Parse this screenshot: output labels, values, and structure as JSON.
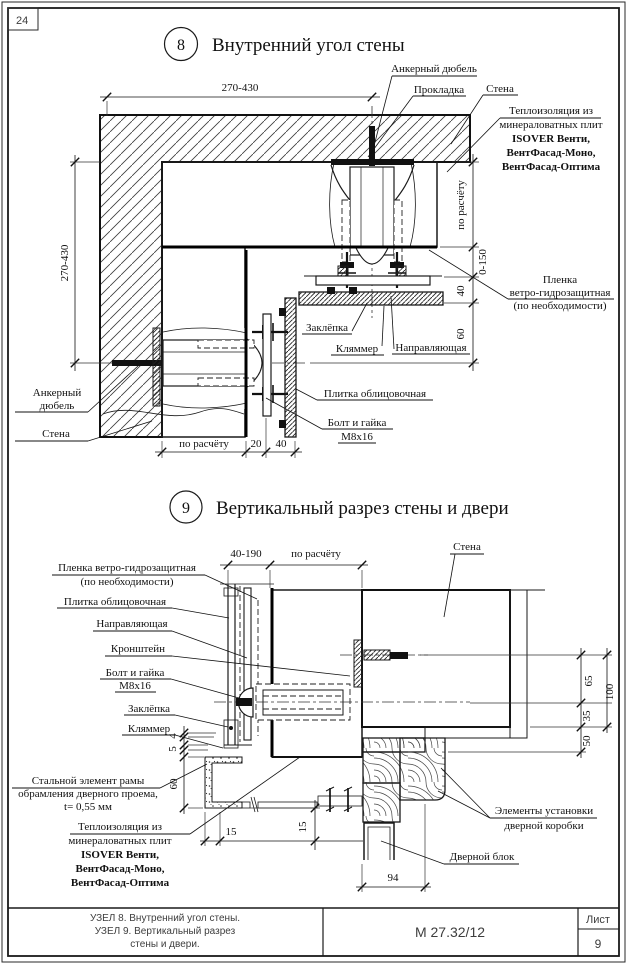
{
  "page": {
    "corner_number": "24"
  },
  "title_block": {
    "description_lines": [
      "УЗЕЛ 8. Внутренний угол стены.",
      "УЗЕЛ 9. Вертикальный разрез",
      "стены и двери."
    ],
    "doc_number": "М 27.32/12",
    "sheet_label": "Лист",
    "sheet_number": "9"
  },
  "detail8": {
    "number": "8",
    "title": "Внутренний угол стены",
    "labels": [
      {
        "name": "label-anchor-dowel-top",
        "lines": [
          "Анкерный дюбель"
        ],
        "x": 434,
        "y": 72,
        "lh": 13,
        "underlines": [
          [
            392,
            477,
            76
          ]
        ],
        "leaders": [
          [
            [
              392,
              76
            ],
            [
              374,
              146
            ]
          ]
        ]
      },
      {
        "name": "label-gasket",
        "lines": [
          "Прокладка"
        ],
        "x": 439,
        "y": 93,
        "lh": 13,
        "underlines": [
          [
            413,
            466,
            96
          ]
        ],
        "leaders": [
          [
            [
              413,
              96
            ],
            [
              368,
              157
            ]
          ]
        ]
      },
      {
        "name": "label-wall-top",
        "lines": [
          "Стена"
        ],
        "x": 500,
        "y": 92,
        "lh": 13,
        "underlines": [
          [
            483,
            518,
            95
          ]
        ],
        "leaders": [
          [
            [
              483,
              95
            ],
            [
              451,
              144
            ]
          ]
        ]
      },
      {
        "name": "label-insulation-8",
        "lines": [
          "Теплоизоляция из",
          "минераловатных плит",
          "ISOVER Венти,",
          "ВентФасад-Моно,",
          "ВентФасад-Оптима"
        ],
        "x": 551,
        "y": 114,
        "lh": 14,
        "bold_from": 2,
        "underlines": [
          [
            500,
            601,
            118
          ]
        ],
        "leaders": [
          [
            [
              500,
              118
            ],
            [
              447,
              172
            ]
          ]
        ]
      },
      {
        "name": "label-membrane-8",
        "lines": [
          "Пленка",
          "ветро-гидрозащитная",
          "(по необходимости)"
        ],
        "x": 560,
        "y": 283,
        "lh": 13,
        "underlines": [
          [
            508,
            614,
            299
          ]
        ],
        "leaders": [
          [
            [
              508,
              299
            ],
            [
              429,
              250
            ]
          ]
        ]
      },
      {
        "name": "label-rivet-8",
        "lines": [
          "Заклёпка"
        ],
        "x": 327,
        "y": 331,
        "lh": 13,
        "underlines": [
          [
            302,
            352,
            334
          ]
        ],
        "leaders": [
          [
            [
              352,
              331
            ],
            [
              367,
              303
            ]
          ]
        ]
      },
      {
        "name": "label-clamp-8",
        "lines": [
          "Кляммер"
        ],
        "x": 357,
        "y": 352,
        "lh": 13,
        "underlines": [
          [
            331,
            384,
            355
          ]
        ],
        "leaders": [
          [
            [
              382,
              346
            ],
            [
              384,
              306
            ]
          ]
        ]
      },
      {
        "name": "label-rail-8",
        "lines": [
          "Направляющая"
        ],
        "x": 431,
        "y": 351,
        "lh": 13,
        "underlines": [
          [
            392,
            470,
            354
          ]
        ],
        "leaders": [
          [
            [
              394,
              349
            ],
            [
              391,
              296
            ]
          ]
        ]
      },
      {
        "name": "label-tile-8",
        "lines": [
          "Плитка облицовочная"
        ],
        "x": 375,
        "y": 397,
        "lh": 13,
        "underlines": [
          [
            317,
            433,
            400
          ]
        ],
        "leaders": [
          [
            [
              317,
              400
            ],
            [
              296,
              389
            ]
          ]
        ]
      },
      {
        "name": "label-bolt-8",
        "lines": [
          "Болт и гайка",
          "М8х16"
        ],
        "x": 357,
        "y": 426,
        "lh": 14,
        "underlines": [
          [
            322,
            393,
            429
          ],
          [
            338,
            376,
            443
          ]
        ],
        "leaders": [
          [
            [
              322,
              429
            ],
            [
              266,
              398
            ]
          ]
        ]
      },
      {
        "name": "label-anchor-dowel-left",
        "lines": [
          "Анкерный",
          "дюбель"
        ],
        "x": 57,
        "y": 396,
        "lh": 13,
        "underlines": [
          [
            15,
            88,
            412
          ]
        ],
        "leaders": [
          [
            [
              88,
              412
            ],
            [
              138,
              366
            ]
          ]
        ]
      },
      {
        "name": "label-wall-left",
        "lines": [
          "Стена"
        ],
        "x": 56,
        "y": 437,
        "lh": 13,
        "underlines": [
          [
            15,
            88,
            441
          ]
        ],
        "leaders": [
          [
            [
              88,
              441
            ],
            [
              152,
              421
            ]
          ]
        ]
      }
    ],
    "dims": [
      {
        "name": "dim-270-430-top",
        "text": "270-430",
        "tx": 240,
        "ty": 91,
        "rot": 0,
        "line": [
          100,
          97,
          380,
          97
        ],
        "ticks": [
          [
            107,
            97
          ],
          [
            372,
            97
          ]
        ]
      },
      {
        "name": "dim-270-430-left",
        "text": "270-430",
        "tx": 68,
        "ty": 263,
        "rot": 1,
        "line": [
          75,
          155,
          75,
          371
        ],
        "ticks": [
          [
            75,
            162
          ],
          [
            75,
            363
          ]
        ]
      },
      {
        "name": "dim-po-raschetu-right",
        "text": "по расчёту",
        "tx": 464,
        "ty": 205,
        "rot": 1,
        "line": [
          473,
          154,
          473,
          371
        ],
        "ticks": [
          [
            473,
            162
          ],
          [
            473,
            247
          ]
        ]
      },
      {
        "name": "dim-0-150",
        "text": "0-150",
        "tx": 486,
        "ty": 262,
        "rot": 1,
        "ticks": [
          [
            473,
            277
          ]
        ]
      },
      {
        "name": "dim-40-right",
        "text": "40",
        "tx": 464,
        "ty": 291,
        "rot": 1,
        "ticks": [
          [
            473,
            303
          ]
        ]
      },
      {
        "name": "dim-60-right",
        "text": "60",
        "tx": 464,
        "ty": 334,
        "rot": 1,
        "ticks": [
          [
            473,
            363
          ]
        ]
      },
      {
        "name": "dim-po-raschetu-bottom",
        "text": "по расчёту",
        "tx": 204,
        "ty": 447,
        "rot": 0,
        "line": [
          155,
          452,
          302,
          452
        ],
        "ticks": [
          [
            162,
            452
          ],
          [
            246,
            452
          ]
        ]
      },
      {
        "name": "dim-20-bottom",
        "text": "20",
        "tx": 256,
        "ty": 447,
        "rot": 0,
        "ticks": [
          [
            266,
            452
          ]
        ]
      },
      {
        "name": "dim-40-bottom",
        "text": "40",
        "tx": 281,
        "ty": 447,
        "rot": 0,
        "ticks": [
          [
            295,
            452
          ]
        ]
      }
    ]
  },
  "detail9": {
    "number": "9",
    "title": "Вертикальный разрез стены и двери",
    "labels": [
      {
        "name": "label-membrane-9",
        "lines": [
          "Пленка ветро-гидрозащитная",
          "(по необходимости)"
        ],
        "x": 127,
        "y": 571,
        "lh": 14,
        "underlines": [
          [
            52,
            205,
            575
          ]
        ],
        "leaders": [
          [
            [
              205,
              575
            ],
            [
              257,
              599
            ]
          ]
        ]
      },
      {
        "name": "label-tile-9",
        "lines": [
          "Плитка облицовочная"
        ],
        "x": 115,
        "y": 605,
        "lh": 13,
        "underlines": [
          [
            57,
            172,
            608
          ]
        ],
        "leaders": [
          [
            [
              172,
              608
            ],
            [
              229,
              618
            ]
          ]
        ]
      },
      {
        "name": "label-rail-9",
        "lines": [
          "Направляющая"
        ],
        "x": 132,
        "y": 627,
        "lh": 13,
        "underlines": [
          [
            93,
            172,
            631
          ]
        ],
        "leaders": [
          [
            [
              172,
              631
            ],
            [
              247,
              658
            ]
          ]
        ]
      },
      {
        "name": "label-bracket-9",
        "lines": [
          "Кронштейн"
        ],
        "x": 138,
        "y": 652,
        "lh": 13,
        "underlines": [
          [
            105,
            172,
            656
          ]
        ],
        "leaders": [
          [
            [
              172,
              656
            ],
            [
              350,
              676
            ]
          ]
        ]
      },
      {
        "name": "label-bolt-9",
        "lines": [
          "Болт и гайка",
          "М8х16"
        ],
        "x": 135,
        "y": 676,
        "lh": 13,
        "underlines": [
          [
            100,
            171,
            679
          ],
          [
            115,
            156,
            692
          ]
        ],
        "leaders": [
          [
            [
              171,
              679
            ],
            [
              246,
              700
            ]
          ]
        ]
      },
      {
        "name": "label-rivet-9",
        "lines": [
          "Заклёпка"
        ],
        "x": 149,
        "y": 712,
        "lh": 13,
        "underlines": [
          [
            124,
            175,
            715
          ]
        ],
        "leaders": [
          [
            [
              175,
              715
            ],
            [
              228,
              727
            ]
          ]
        ]
      },
      {
        "name": "label-clamp-9",
        "lines": [
          "Кляммер"
        ],
        "x": 149,
        "y": 732,
        "lh": 13,
        "underlines": [
          [
            122,
            175,
            735
          ]
        ],
        "leaders": [
          [
            [
              175,
              735
            ],
            [
              223,
              748
            ]
          ]
        ]
      },
      {
        "name": "label-steel-frame",
        "lines": [
          "Стальной элемент рамы",
          "обрамления  дверного проема,",
          "t= 0,55 мм"
        ],
        "x": 88,
        "y": 784,
        "lh": 13,
        "underlines": [
          [
            12,
            160,
            788
          ]
        ],
        "leaders": [
          [
            [
              160,
              788
            ],
            [
              207,
              764
            ]
          ]
        ]
      },
      {
        "name": "label-insulation-9",
        "lines": [
          "Теплоизоляция из",
          "минераловатных плит",
          "ISOVER Венти,",
          "ВентФасад-Моно,",
          "ВентФасад-Оптима"
        ],
        "x": 120,
        "y": 830,
        "lh": 14,
        "bold_from": 2,
        "underlines": [
          [
            70,
            190,
            834
          ]
        ],
        "leaders": [
          [
            [
              190,
              834
            ],
            [
              300,
              757
            ]
          ]
        ]
      },
      {
        "name": "label-door-frame-elements",
        "lines": [
          "Элементы установки",
          "дверной коробки"
        ],
        "x": 544,
        "y": 814,
        "lh": 15,
        "underlines": [
          [
            490,
            597,
            818
          ]
        ],
        "leaders": [
          [
            [
              490,
              818
            ],
            [
              438,
              791
            ]
          ],
          [
            [
              490,
              818
            ],
            [
              441,
              768
            ]
          ]
        ]
      },
      {
        "name": "label-door-block",
        "lines": [
          "Дверной блок"
        ],
        "x": 482,
        "y": 860,
        "lh": 13,
        "underlines": [
          [
            444,
            519,
            864
          ]
        ],
        "leaders": [
          [
            [
              444,
              864
            ],
            [
              381,
              841
            ]
          ]
        ]
      },
      {
        "name": "label-wall-9",
        "lines": [
          "Стена"
        ],
        "x": 467,
        "y": 550,
        "lh": 13,
        "underlines": [
          [
            450,
            484,
            554
          ]
        ],
        "leaders": [
          [
            [
              455,
              554
            ],
            [
              444,
              617
            ]
          ]
        ]
      }
    ],
    "dims": [
      {
        "name": "dim-40-190",
        "text": "40-190",
        "tx": 246,
        "ty": 557,
        "rot": 0,
        "line": [
          220,
          565,
          368,
          565
        ],
        "ticks": [
          [
            228,
            565
          ],
          [
            270,
            565
          ]
        ]
      },
      {
        "name": "dim-po-raschetu-9",
        "text": "по расчёту",
        "tx": 316,
        "ty": 557,
        "rot": 0,
        "ticks": [
          [
            362,
            565
          ]
        ]
      },
      {
        "name": "dim-65",
        "text": "65",
        "tx": 592,
        "ty": 681,
        "rot": 1,
        "line": [
          581,
          648,
          581,
          758
        ],
        "ticks": [
          [
            581,
            655
          ],
          [
            581,
            703
          ]
        ]
      },
      {
        "name": "dim-35",
        "text": "35",
        "tx": 590,
        "ty": 716,
        "rot": 1,
        "ticks": [
          [
            581,
            727
          ]
        ]
      },
      {
        "name": "dim-50",
        "text": "50",
        "tx": 590,
        "ty": 741,
        "rot": 1,
        "ticks": [
          [
            581,
            752
          ]
        ]
      },
      {
        "name": "dim-100",
        "text": "100",
        "tx": 613,
        "ty": 692,
        "rot": 1,
        "line": [
          607,
          648,
          607,
          733
        ],
        "ticks": [
          [
            607,
            655
          ],
          [
            607,
            727
          ]
        ]
      },
      {
        "name": "dim-4",
        "text": "4",
        "tx": 176,
        "ty": 736,
        "rot": 1,
        "line": [
          184,
          726,
          184,
          814
        ],
        "ticks": [
          [
            184,
            733
          ],
          [
            184,
            737
          ]
        ]
      },
      {
        "name": "dim-5",
        "text": "5",
        "tx": 176,
        "ty": 749,
        "rot": 1,
        "ticks": [
          [
            184,
            745
          ],
          [
            184,
            750
          ]
        ]
      },
      {
        "name": "dim-60-9",
        "text": "60",
        "tx": 177,
        "ty": 784,
        "rot": 1,
        "ticks": [
          [
            184,
            757
          ],
          [
            184,
            808
          ]
        ]
      },
      {
        "name": "dim-15-h",
        "text": "15",
        "tx": 231,
        "ty": 835,
        "rot": 0,
        "line": [
          200,
          841,
          363,
          841
        ],
        "ticks": [
          [
            205,
            841
          ],
          [
            220,
            841
          ]
        ]
      },
      {
        "name": "dim-15-v",
        "text": "15",
        "tx": 306,
        "ty": 827,
        "rot": 1,
        "line": [
          315,
          800,
          315,
          850
        ],
        "ticks": [
          [
            315,
            808
          ],
          [
            315,
            841
          ]
        ]
      },
      {
        "name": "dim-94",
        "text": "94",
        "tx": 393,
        "ty": 881,
        "rot": 0,
        "line": [
          356,
          887,
          431,
          887
        ],
        "ticks": [
          [
            362,
            887
          ],
          [
            425,
            887
          ]
        ]
      }
    ]
  }
}
